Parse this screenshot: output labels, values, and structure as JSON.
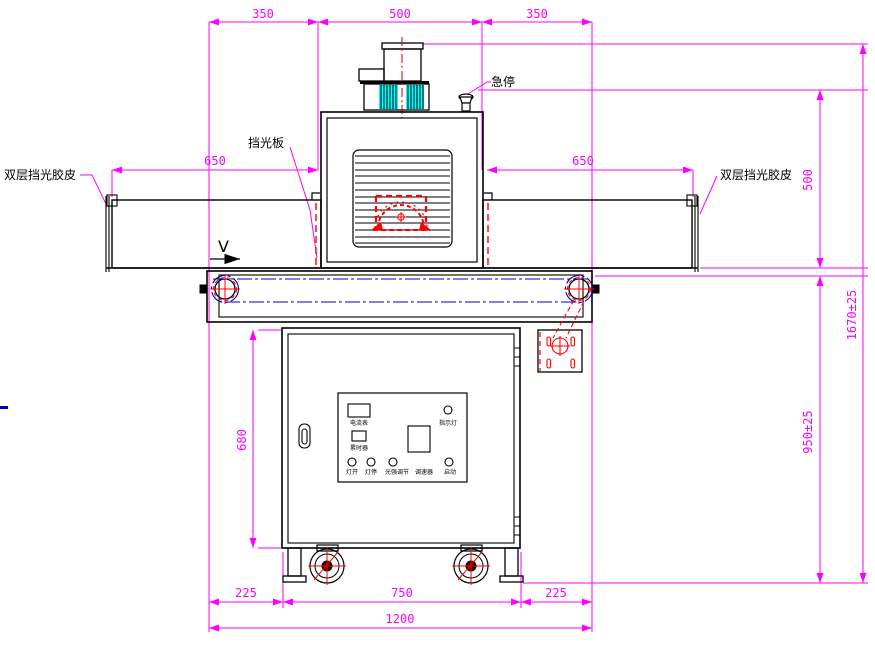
{
  "drawing": {
    "type": "engineering-front-view",
    "dimensions": {
      "top_left": "350",
      "top_center": "500",
      "top_right": "350",
      "tunnel_left": "650",
      "tunnel_right": "650",
      "oven_height": "500",
      "total_height": "1670±25",
      "belt_height": "950±25",
      "cabinet_height": "680",
      "bottom_left": "225",
      "bottom_center": "750",
      "bottom_right": "225",
      "total_width": "1200"
    },
    "labels": {
      "emergency_stop": "急停",
      "light_shield_plate": "挡光板",
      "double_rubber_left": "双层挡光胶皮",
      "double_rubber_right": "双层挡光胶皮",
      "belt_direction": "V"
    },
    "control_panel": {
      "ammeter": "电流表",
      "hour_meter": "累时器",
      "indicator_lamp": "指示灯",
      "lamp_on": "灯开",
      "lamp_off": "灯停",
      "intensity_adjust": "光强调节",
      "speed_controller": "调速器",
      "start": "启动"
    },
    "colors": {
      "dimension": "#ff00ff",
      "outline": "#000000",
      "detail_red": "#ff0000",
      "centerline_blue": "#0000c0",
      "fan_cyan": "#00ffff",
      "background": "#ffffff"
    }
  }
}
